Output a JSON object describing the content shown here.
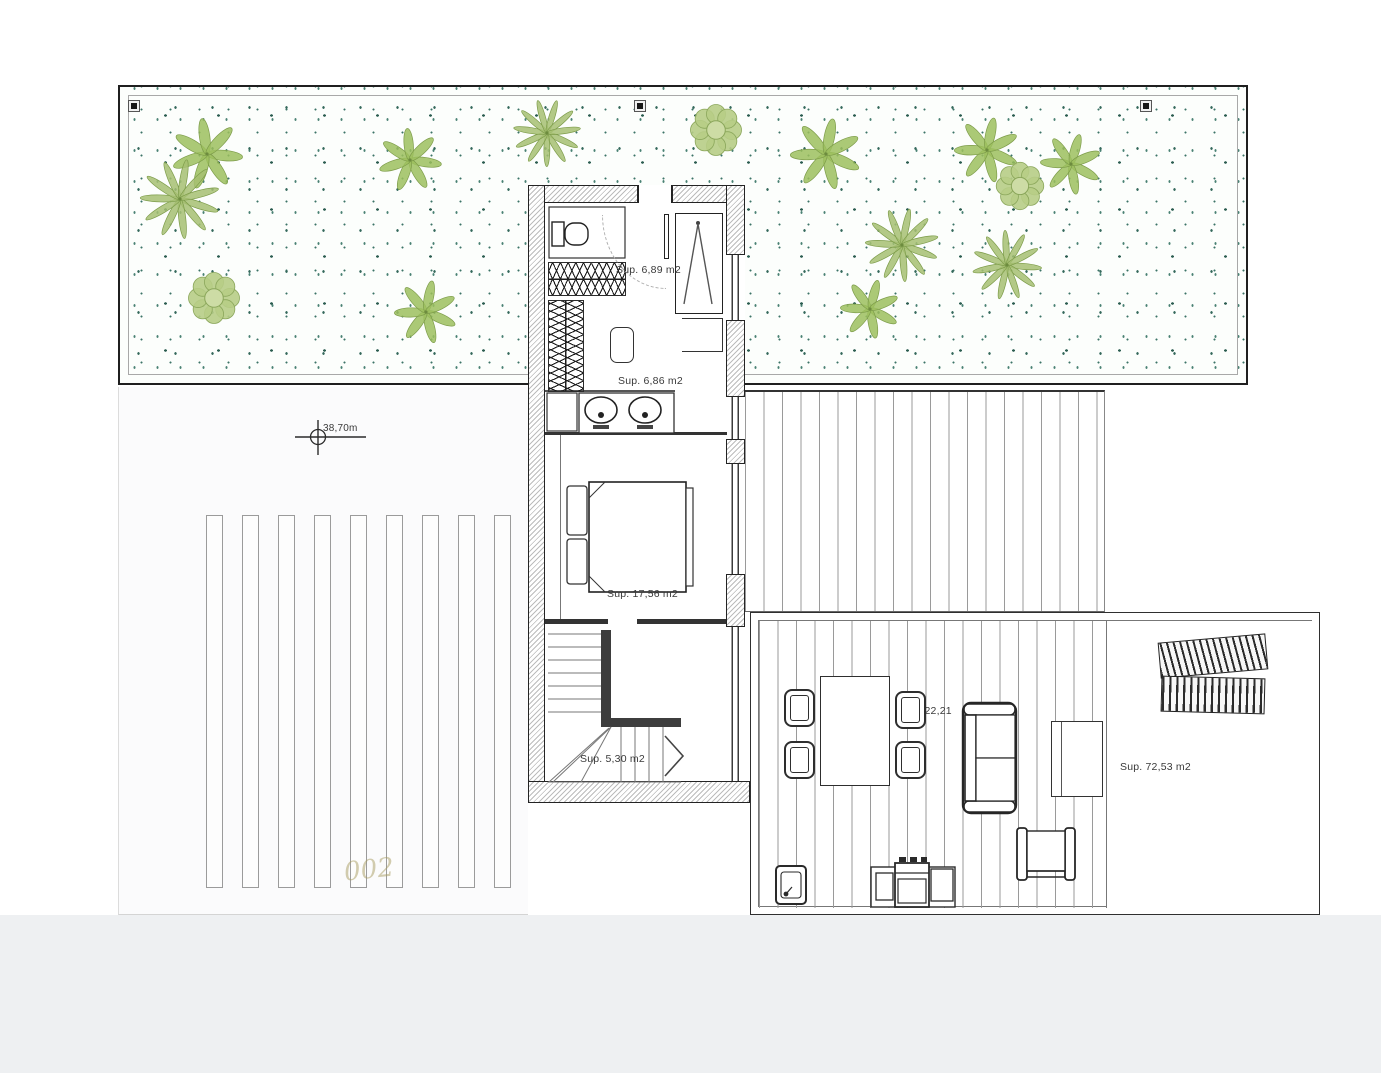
{
  "labels": {
    "hall_area": "Sup. 6,89 m2",
    "bath_area": "Sup. 6,86 m2",
    "bedroom_area": "Sup. 17,56 m2",
    "stairs_area": "Sup. 5,30 m2",
    "porch_area": "Sup. 22,21",
    "terrace_area": "Sup. 72,53 m2",
    "level_mark": "38,70m",
    "watermark": "002"
  },
  "colors": {
    "gravel_dot": "#35695c",
    "plant_green": "#9cbf5e",
    "plan_line": "#2e2e2e",
    "deck_line": "#9a9a9a"
  },
  "garden": {
    "markers_x": [
      8,
      514,
      1020
    ],
    "plants": [
      {
        "type": "palm",
        "x": 205,
        "y": 152,
        "size": 70
      },
      {
        "type": "fern",
        "x": 178,
        "y": 197,
        "size": 78
      },
      {
        "type": "bush",
        "x": 212,
        "y": 296,
        "size": 58
      },
      {
        "type": "palm",
        "x": 408,
        "y": 158,
        "size": 62
      },
      {
        "type": "palm",
        "x": 424,
        "y": 310,
        "size": 62
      },
      {
        "type": "fern",
        "x": 545,
        "y": 131,
        "size": 66
      },
      {
        "type": "bush",
        "x": 714,
        "y": 128,
        "size": 58
      },
      {
        "type": "palm",
        "x": 824,
        "y": 152,
        "size": 70
      },
      {
        "type": "fern",
        "x": 900,
        "y": 243,
        "size": 72
      },
      {
        "type": "palm",
        "x": 868,
        "y": 307,
        "size": 58
      },
      {
        "type": "palm",
        "x": 985,
        "y": 148,
        "size": 64
      },
      {
        "type": "bush",
        "x": 1018,
        "y": 184,
        "size": 54
      },
      {
        "type": "palm",
        "x": 1069,
        "y": 162,
        "size": 60
      },
      {
        "type": "fern",
        "x": 1005,
        "y": 263,
        "size": 68
      }
    ]
  }
}
